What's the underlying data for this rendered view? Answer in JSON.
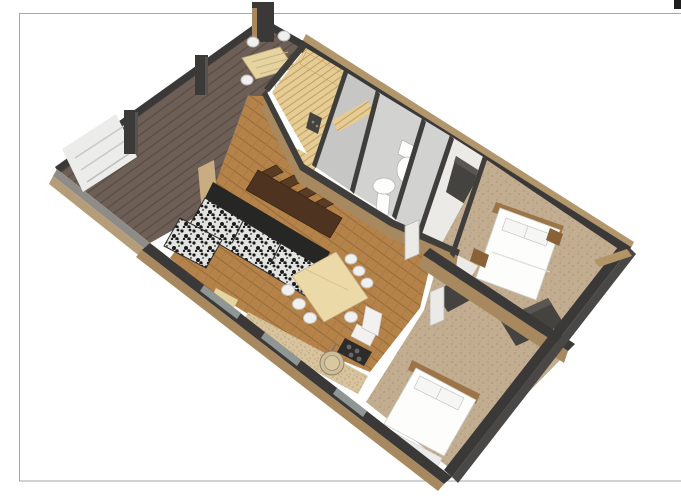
{
  "page": {
    "background": "#ffffff",
    "border_color": "#a6a6a6",
    "corner_mark_color": "#1f1f1f"
  },
  "palette": {
    "deck_wood": "#6d5e56",
    "deck_plank_line": "#594c44",
    "slab_gray": "#8f8c88",
    "slab_tan": "#b59d79",
    "exterior_wall_dark": "#3b3937",
    "exterior_wall_face": "#4a4846",
    "wall_cap_dark": "#403e3b",
    "wall_face_tan": "#a8895f",
    "wall_face_tan_light": "#b2966c",
    "oak_floor": "#b5834a",
    "oak_plank_line": "#976c38",
    "pine": "#e5cb94",
    "pine_line": "#c19e60",
    "tile_gray": "#d2d2d0",
    "tile_gray_dark": "#c6c6c4",
    "hall_floor": "#eceae6",
    "carpet": "#c2ad91",
    "carpet_dot": "#af987b",
    "counter_beige": "#d7c39d",
    "counter_dot": "#b99f74",
    "white_fixture": "#fdfdfc",
    "fixture_stroke": "#b5b5b3",
    "bench_white": "#ececea",
    "bench_line": "#c9c9c7",
    "post_dark": "#3c3a38",
    "table_outdoor": "#e5d3a0",
    "table_light": "#ecd9a8",
    "table_light_stroke": "#c9b184",
    "table_dark": "#4e3420",
    "chair_white": "#f0f0ee",
    "chair_dark": "#5a3c24",
    "sofa_back_dark": "#262624",
    "bed_white": "#fdfdfc",
    "headboard_wood": "#9c7448",
    "nightstand_wood": "#8a6238",
    "closet_dark": "#45433f",
    "cooktop_black": "#2e2c2a",
    "burner_gray": "#6a6865",
    "appliance_white": "#f2f1ef",
    "glass_tint": "#7e8d96",
    "door_frame_tan": "#c9ad82",
    "window_glass": "#8f9694",
    "sill_tan": "#b29467"
  },
  "scene": {
    "type": "3d-floor-plan-render",
    "view": "aerial-cutaway-perspective",
    "rooms": [
      {
        "id": "deck",
        "label": "deck-terrace"
      },
      {
        "id": "sauna",
        "label": "sauna"
      },
      {
        "id": "shower",
        "label": "shower-room"
      },
      {
        "id": "bathroom",
        "label": "bathroom"
      },
      {
        "id": "wc",
        "label": "wc-storage"
      },
      {
        "id": "hall",
        "label": "hallway"
      },
      {
        "id": "living",
        "label": "living-room"
      },
      {
        "id": "dining",
        "label": "dining-area"
      },
      {
        "id": "kitchen",
        "label": "kitchen"
      },
      {
        "id": "bedroom_right",
        "label": "bedroom-east"
      },
      {
        "id": "bedroom_bottom",
        "label": "bedroom-south"
      }
    ],
    "furniture": [
      "outdoor-table",
      "outdoor-chairs",
      "deck-bench",
      "sauna-benches",
      "sauna-heater",
      "shower-bench",
      "toilet",
      "pedestal-sink",
      "sectional-sofa",
      "ottoman",
      "dark-dining-table",
      "dark-chairs",
      "light-dining-table",
      "white-chairs",
      "kitchen-counter",
      "round-sink",
      "cooktop",
      "fridge",
      "double-bed-east",
      "double-bed-south",
      "nightstands",
      "wardrobes",
      "interior-doors"
    ]
  }
}
